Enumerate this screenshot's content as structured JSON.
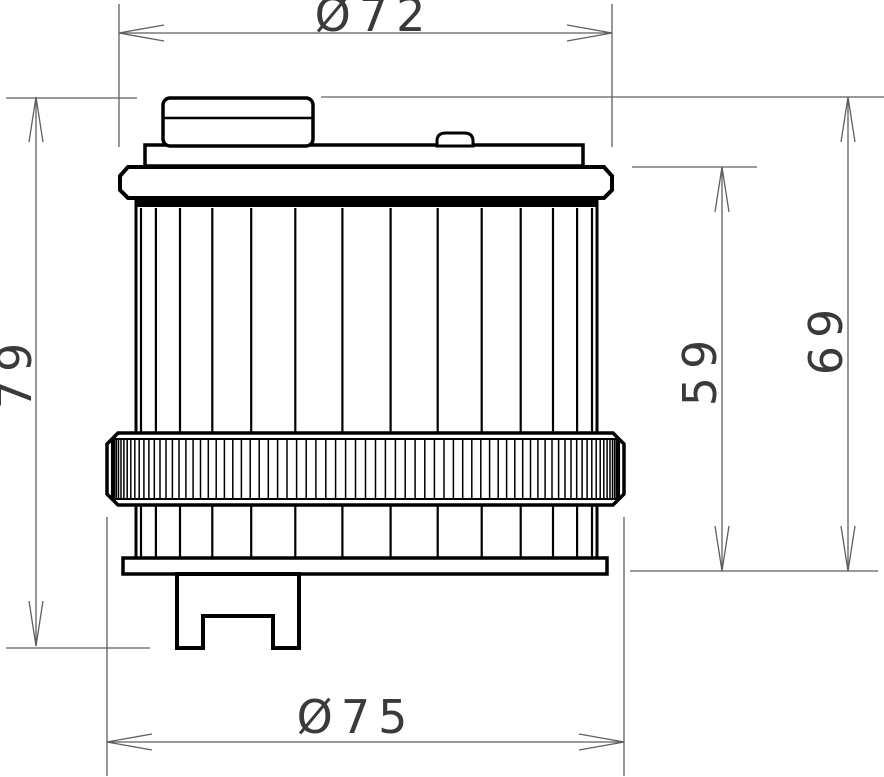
{
  "drawing": {
    "type": "technical-dimension-drawing",
    "subject": "oil-filter-side-view",
    "background": "#ffffff",
    "colors": {
      "part_outline": "#000000",
      "dimension_lines": "#5f5f5f",
      "dimension_text": "#3a3a3a"
    },
    "dimensions": {
      "top_diameter": {
        "label": "Ø72",
        "value": 72,
        "orientation": "horizontal"
      },
      "bottom_diameter": {
        "label": "Ø75",
        "value": 75,
        "orientation": "horizontal"
      },
      "overall_height": {
        "label": "79",
        "value": 79,
        "orientation": "vertical"
      },
      "outer_height": {
        "label": "69",
        "value": 69,
        "orientation": "vertical"
      },
      "inner_height": {
        "label": "59",
        "value": 59,
        "orientation": "vertical"
      }
    }
  }
}
